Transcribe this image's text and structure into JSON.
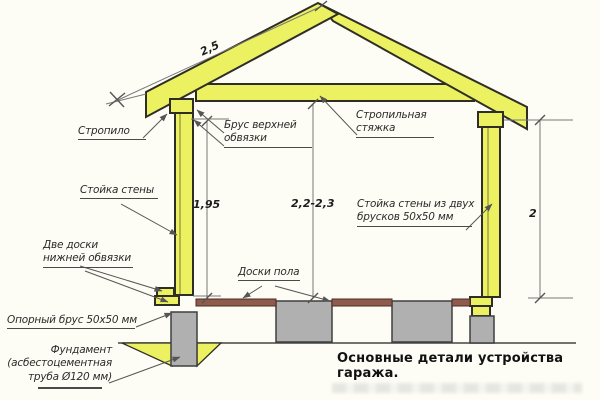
{
  "diagram": {
    "caption": "Основные детали устройства гаража.",
    "labels": {
      "rafter": "Стропило",
      "top_beam": [
        "Брус верхней",
        "обвязки"
      ],
      "tie": [
        "Стропильная",
        "стяжка"
      ],
      "wall_post": "Стойка стены",
      "double_post": [
        "Стойка стены из двух",
        "брусков 50х50 мм"
      ],
      "lower_strap": [
        "Две доски",
        "нижней обвязки"
      ],
      "floor_boards": "Доски пола",
      "support_beam": "Опорный брус 50х50 мм",
      "foundation": [
        "Фундамент",
        "(асбестоцементная",
        "труба Ø120 мм)"
      ]
    },
    "dimensions": {
      "roof_slope": "2,5",
      "left_wall": "1,95",
      "interior_height": "2,2-2,3",
      "right_wall": "2"
    },
    "colors": {
      "wood": "#ecf161",
      "floor": "#8f5b4d",
      "concrete": "#b0b0b0",
      "outline": "#2e2e26",
      "dim_line": "#777777",
      "text": "#2b2b2b"
    }
  }
}
